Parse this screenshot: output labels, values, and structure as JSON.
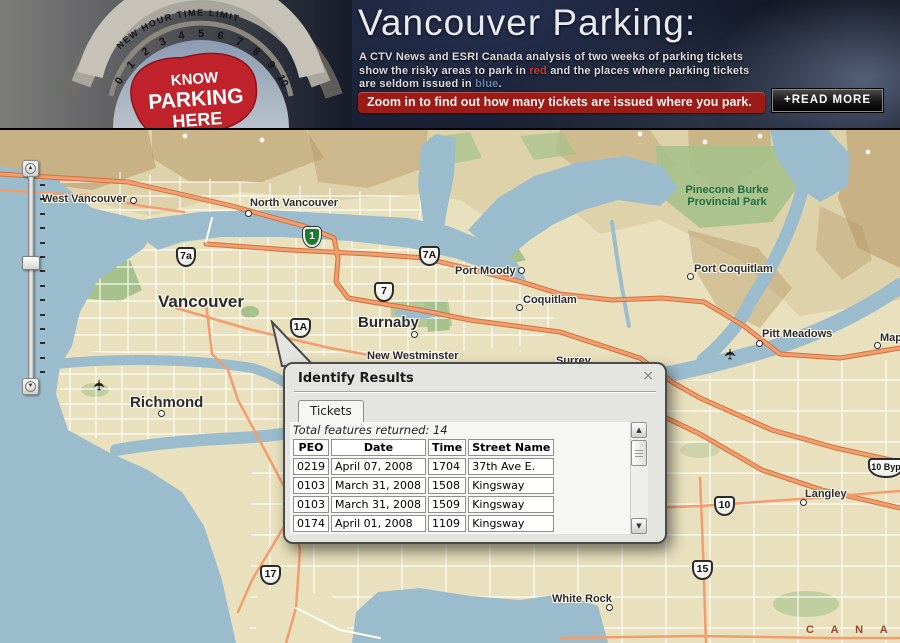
{
  "header": {
    "title": "Vancouver Parking:",
    "description": {
      "line1": "A CTV News and ESRI Canada analysis of two weeks of parking tickets",
      "line2_before": "show the risky areas to park in ",
      "red_word": "red",
      "line2_after": " and the places where parking tickets",
      "line3_before": "are seldom issued in ",
      "blue_word": "blue",
      "line3_after": "."
    },
    "banner": "Zoom in to find out how many tickets are issued where you park.",
    "read_more_label": "+READ MORE",
    "meter": {
      "arc_label": "NEW HOUR TIME LIMIT",
      "dial_numbers": [
        "0",
        "1",
        "2",
        "3",
        "4",
        "5",
        "6",
        "7",
        "8",
        "9",
        "10"
      ],
      "blob_line1": "KNOW",
      "blob_line2": "PARKING",
      "blob_line3": "HERE",
      "blob_color": "#c0232b"
    },
    "colors": {
      "banner_red": "#9b1b17",
      "red_word": "#d13a31",
      "blue_word": "#5d88b2"
    }
  },
  "map": {
    "colors": {
      "water": "#9bbccd",
      "land": "#e9e1bd",
      "park": "#a6c18b",
      "mountain": "#b2925f",
      "road_major": "#f29d6e",
      "road_minor": "#ffffff"
    },
    "cities": [
      {
        "label": "West Vancouver",
        "x": 42,
        "y": 63,
        "size": 11,
        "marker": {
          "x": 133,
          "y": 70
        }
      },
      {
        "label": "North Vancouver",
        "x": 250,
        "y": 67,
        "size": 11,
        "marker": {
          "x": 248,
          "y": 83
        }
      },
      {
        "label": "Vancouver",
        "x": 158,
        "y": 162,
        "size": 17,
        "marker": null
      },
      {
        "label": "Burnaby",
        "x": 358,
        "y": 184,
        "size": 15,
        "marker": {
          "x": 414,
          "y": 204
        }
      },
      {
        "label": "New Westminster",
        "x": 367,
        "y": 220,
        "size": 11,
        "marker": null
      },
      {
        "label": "Richmond",
        "x": 130,
        "y": 264,
        "size": 15,
        "marker": {
          "x": 161,
          "y": 283
        }
      },
      {
        "label": "Port Moody",
        "x": 455,
        "y": 135,
        "size": 11,
        "marker": {
          "x": 521,
          "y": 140
        }
      },
      {
        "label": "Coquitlam",
        "x": 523,
        "y": 164,
        "size": 11,
        "marker": {
          "x": 519,
          "y": 177
        }
      },
      {
        "label": "Port Coquitlam",
        "x": 694,
        "y": 133,
        "size": 11,
        "marker": {
          "x": 690,
          "y": 146
        }
      },
      {
        "label": "Pitt Meadows",
        "x": 762,
        "y": 198,
        "size": 11,
        "marker": {
          "x": 759,
          "y": 213
        }
      },
      {
        "label": "Maple Ridge",
        "x": 880,
        "y": 202,
        "size": 11,
        "marker": {
          "x": 877,
          "y": 215
        }
      },
      {
        "label": "Surrey",
        "x": 556,
        "y": 225,
        "size": 11,
        "marker": null
      },
      {
        "label": "Langley",
        "x": 805,
        "y": 358,
        "size": 11,
        "marker": {
          "x": 803,
          "y": 372
        }
      },
      {
        "label": "White Rock",
        "x": 552,
        "y": 463,
        "size": 11,
        "marker": {
          "x": 609,
          "y": 477
        }
      }
    ],
    "park_label": {
      "line1": "Pinecone Burke",
      "line2": "Provincial Park",
      "x": 727,
      "y": 54
    },
    "country_label": {
      "text": "C A N A D A",
      "x": 806,
      "y": 494
    },
    "shields": [
      {
        "label": "7a",
        "x": 176,
        "y": 117,
        "variant": "white",
        "w": 20
      },
      {
        "label": "1",
        "x": 303,
        "y": 97,
        "variant": "green",
        "w": 18
      },
      {
        "label": "7A",
        "x": 419,
        "y": 116,
        "variant": "white",
        "w": 21
      },
      {
        "label": "7",
        "x": 374,
        "y": 152,
        "variant": "white",
        "w": 20
      },
      {
        "label": "1A",
        "x": 290,
        "y": 188,
        "variant": "white",
        "w": 21
      },
      {
        "label": "10",
        "x": 714,
        "y": 366,
        "variant": "white",
        "w": 21
      },
      {
        "label": "10 Byp",
        "x": 868,
        "y": 328,
        "variant": "white",
        "w": 36
      },
      {
        "label": "15",
        "x": 692,
        "y": 430,
        "variant": "white",
        "w": 21
      },
      {
        "label": "17",
        "x": 260,
        "y": 435,
        "variant": "white",
        "w": 21
      }
    ],
    "airports": [
      {
        "x": 93,
        "y": 246
      },
      {
        "x": 724,
        "y": 215
      }
    ],
    "icons": {
      "plane": "✈",
      "zoom_in": "▲",
      "zoom_out": "▼"
    }
  },
  "popup": {
    "title": "Identify Results",
    "close_glyph": "×",
    "tab_label": "Tickets",
    "total_text": "Total features returned: 14",
    "table": {
      "headers": [
        "PEO",
        "Date",
        "Time",
        "Street Name"
      ],
      "rows": [
        [
          "0219",
          "April 07, 2008",
          "1704",
          "37th Ave E."
        ],
        [
          "0103",
          "March 31, 2008",
          "1508",
          "Kingsway"
        ],
        [
          "0103",
          "March 31, 2008",
          "1509",
          "Kingsway"
        ],
        [
          "0174",
          "April 01, 2008",
          "1109",
          "Kingsway"
        ]
      ]
    },
    "scrollbar": {
      "up_glyph": "▲",
      "down_glyph": "▼"
    }
  }
}
